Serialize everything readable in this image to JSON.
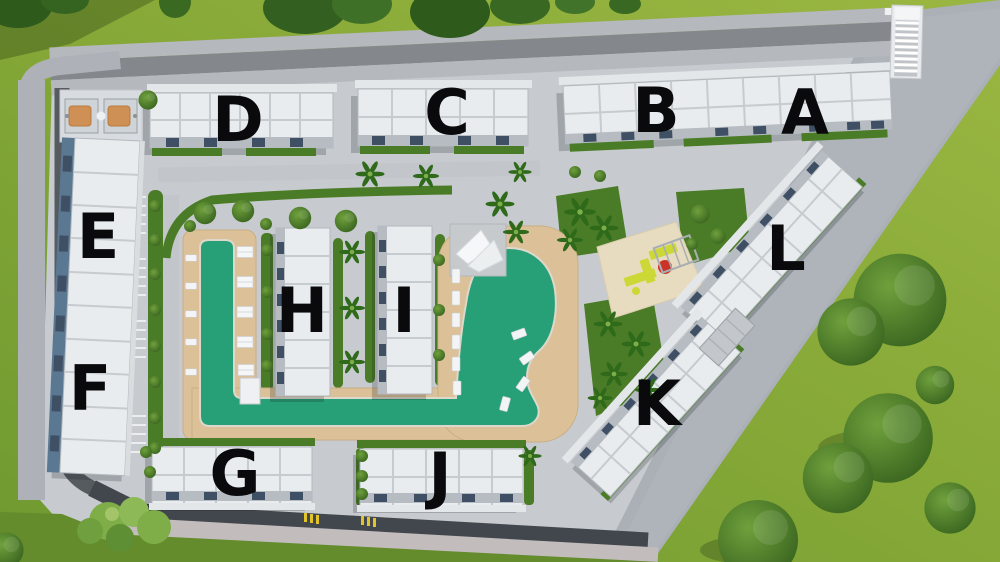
{
  "scene": {
    "title": "Residential complex site plan — aerial 3D render",
    "view": "top-down master plan"
  },
  "buildings": [
    {
      "label": "A"
    },
    {
      "label": "B"
    },
    {
      "label": "C"
    },
    {
      "label": "D"
    },
    {
      "label": "E"
    },
    {
      "label": "F"
    },
    {
      "label": "G"
    },
    {
      "label": "H"
    },
    {
      "label": "I"
    },
    {
      "label": "J"
    },
    {
      "label": "K"
    },
    {
      "label": "L"
    }
  ],
  "amenities": {
    "pool": "swimming-pool",
    "pool_deck": "wooden-deck",
    "shade_sail": "shade-sail",
    "sun_loungers": "sun-loungers",
    "playground": "children-playground",
    "basketball_court": "basketball-court",
    "entrance_stairs": "entrance-stairs",
    "carport": "carport",
    "parking": "parking-stripes",
    "perimeter_road": "perimeter-road",
    "sidewalk": "cobblestone-sidewalk",
    "footpath": "diagonal-footpath",
    "landscaping": "trees-and-hedges"
  },
  "colors": {
    "grass_light": "#9bb742",
    "grass_dark": "#6f9a30",
    "lawn": "#4a7b26",
    "pavement": "#c7cbcf",
    "road_asphalt": "#6a6e73",
    "road_dark": "#43484e",
    "sidewalk_cobble": "#aeb1b7",
    "sidewalk_pink": "#c7c1c2",
    "building_white": "#e9ecee",
    "building_trim": "#b2b8bd",
    "facade_glass": "#5b7893",
    "garage_slot": "#3f5065",
    "pool_water": "#27a077",
    "pool_deck": "#dcc198",
    "court_orange": "#cf9055",
    "playground_pad": "#e7dcc0",
    "play_equipment": "#ccd835",
    "play_accent": "#cc3327",
    "label_text": "#0a0a0c"
  }
}
